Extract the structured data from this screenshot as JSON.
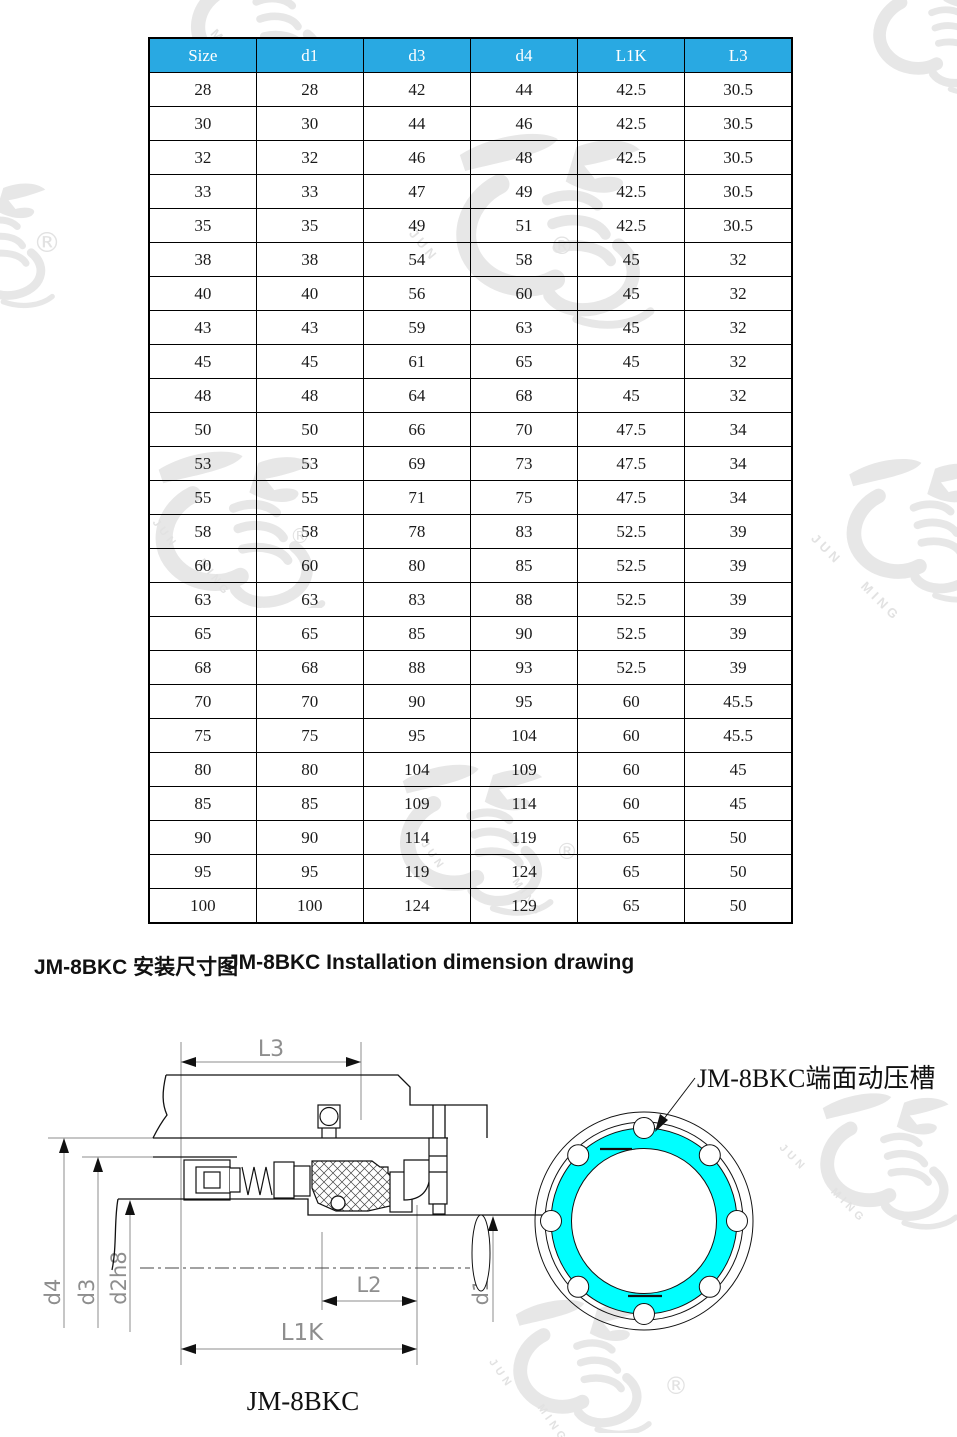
{
  "table": {
    "header_bg": "#29A9E2",
    "header_text_color": "#FFFFFF",
    "columns": [
      "Size",
      "d1",
      "d3",
      "d4",
      "L1K",
      "L3"
    ],
    "rows": [
      [
        "28",
        "28",
        "42",
        "44",
        "42.5",
        "30.5"
      ],
      [
        "30",
        "30",
        "44",
        "46",
        "42.5",
        "30.5"
      ],
      [
        "32",
        "32",
        "46",
        "48",
        "42.5",
        "30.5"
      ],
      [
        "33",
        "33",
        "47",
        "49",
        "42.5",
        "30.5"
      ],
      [
        "35",
        "35",
        "49",
        "51",
        "42.5",
        "30.5"
      ],
      [
        "38",
        "38",
        "54",
        "58",
        "45",
        "32"
      ],
      [
        "40",
        "40",
        "56",
        "60",
        "45",
        "32"
      ],
      [
        "43",
        "43",
        "59",
        "63",
        "45",
        "32"
      ],
      [
        "45",
        "45",
        "61",
        "65",
        "45",
        "32"
      ],
      [
        "48",
        "48",
        "64",
        "68",
        "45",
        "32"
      ],
      [
        "50",
        "50",
        "66",
        "70",
        "47.5",
        "34"
      ],
      [
        "53",
        "53",
        "69",
        "73",
        "47.5",
        "34"
      ],
      [
        "55",
        "55",
        "71",
        "75",
        "47.5",
        "34"
      ],
      [
        "58",
        "58",
        "78",
        "83",
        "52.5",
        "39"
      ],
      [
        "60",
        "60",
        "80",
        "85",
        "52.5",
        "39"
      ],
      [
        "63",
        "63",
        "83",
        "88",
        "52.5",
        "39"
      ],
      [
        "65",
        "65",
        "85",
        "90",
        "52.5",
        "39"
      ],
      [
        "68",
        "68",
        "88",
        "93",
        "52.5",
        "39"
      ],
      [
        "70",
        "70",
        "90",
        "95",
        "60",
        "45.5"
      ],
      [
        "75",
        "75",
        "95",
        "104",
        "60",
        "45.5"
      ],
      [
        "80",
        "80",
        "104",
        "109",
        "60",
        "45"
      ],
      [
        "85",
        "85",
        "109",
        "114",
        "60",
        "45"
      ],
      [
        "90",
        "90",
        "114",
        "119",
        "65",
        "50"
      ],
      [
        "95",
        "95",
        "119",
        "124",
        "65",
        "50"
      ],
      [
        "100",
        "100",
        "124",
        "129",
        "65",
        "50"
      ]
    ]
  },
  "section_title": {
    "cn": "JM-8BKC 安装尺寸图",
    "en": "JM-8BKC Installation dimension drawing"
  },
  "drawing": {
    "labels": {
      "l3": "L3",
      "d4": "d4",
      "d3": "d3",
      "d2h8": "d2h8",
      "d1": "d1",
      "l2": "L2",
      "l1k": "L1K"
    },
    "caption": "JM-8BKC",
    "groove_label": "JM-8BKC端面动压槽",
    "groove_color": "#00FFFF",
    "groove_count": 8
  },
  "watermark": {
    "text_top": "JUN",
    "text_bottom": "MING",
    "registered": "®"
  }
}
